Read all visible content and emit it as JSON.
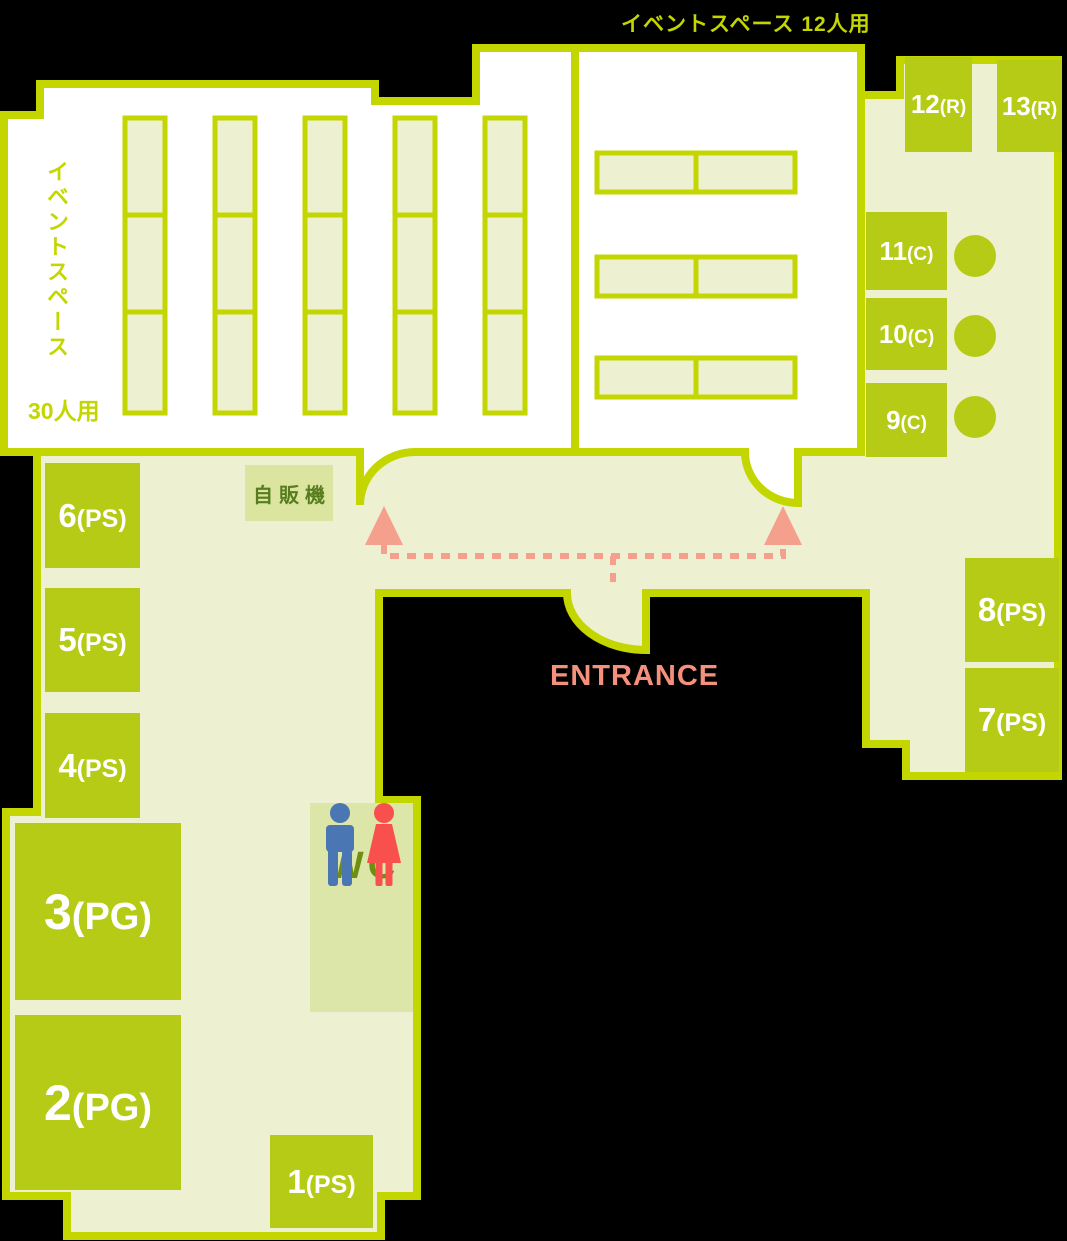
{
  "title": "イベントスペース 12人用",
  "left_space": {
    "label_vertical": "イベントスペース",
    "capacity": "30人用"
  },
  "entrance_label": "ENTRANCE",
  "vending_label": "自販機",
  "wc_label": "WC",
  "rooms": [
    {
      "id": "12R",
      "num": "12",
      "suffix": "(R)"
    },
    {
      "id": "13R",
      "num": "13",
      "suffix": "(R)"
    },
    {
      "id": "11C",
      "num": "11",
      "suffix": "(C)"
    },
    {
      "id": "10C",
      "num": "10",
      "suffix": "(C)"
    },
    {
      "id": "9C",
      "num": "9",
      "suffix": "(C)"
    },
    {
      "id": "8PS",
      "num": "8",
      "suffix": "(PS)"
    },
    {
      "id": "7PS",
      "num": "7",
      "suffix": "(PS)"
    },
    {
      "id": "6PS",
      "num": "6",
      "suffix": "(PS)"
    },
    {
      "id": "5PS",
      "num": "5",
      "suffix": "(PS)"
    },
    {
      "id": "4PS",
      "num": "4",
      "suffix": "(PS)"
    },
    {
      "id": "3PG",
      "num": "3",
      "suffix": "(PG)"
    },
    {
      "id": "2PG",
      "num": "2",
      "suffix": "(PG)"
    },
    {
      "id": "1PS",
      "num": "1",
      "suffix": "(PS)"
    }
  ],
  "colors": {
    "lime": "#c3d600",
    "floor": "#eef0d2",
    "box": "#b5cb15",
    "panel": "#dce59f",
    "panel2": "#dde6a9",
    "ink-green": "#567d1e",
    "olive": "#6e8e12",
    "salmon": "#f5a08d",
    "salmon-text": "#f5907d",
    "man": "#4a76b4",
    "woman": "#f8504d"
  }
}
